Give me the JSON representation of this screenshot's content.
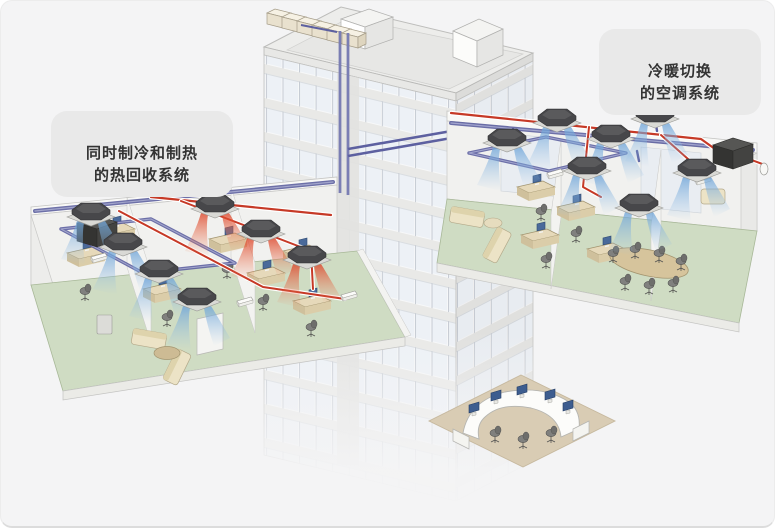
{
  "page": {
    "background_color": "#ffffff",
    "card_color": "#f4f4f5"
  },
  "labels": {
    "heat_recovery": {
      "text": "同时制冷和制热\n的热回收系统"
    },
    "switch_system": {
      "text": "冷暖切换\n的空调系统"
    }
  },
  "colors": {
    "pipe_refrigerant_cool": "#5d60a0",
    "pipe_refrigerant_hot": "#c63926",
    "floor_carpet_green": "#cfdcc3",
    "reception_floor_tan": "#d9ccb4",
    "air_cooling": "#7aa9d8",
    "air_heating": "#e05232",
    "indoor_unit_body": "#4a4a48",
    "outdoor_unit_beige": "#efe8d8",
    "building_face": "#f7f8f9"
  },
  "scene": {
    "building": {
      "type": "office-tower",
      "rooftop_outdoor_units": 6,
      "riser_pipes": 2
    },
    "floors": [
      {
        "id": "heat-recovery-floor",
        "side": "left",
        "system": "同时制冷和制热的热回收系统",
        "indoor_units_cooling": 4,
        "indoor_units_heating": 3
      },
      {
        "id": "switch-floor",
        "side": "right",
        "system": "冷暖切换的空调系统",
        "indoor_units_cooling": 7,
        "indoor_units_heating": 0
      }
    ],
    "lobby": {
      "reception_desks": 1,
      "chairs": 3,
      "monitors": 5
    }
  }
}
